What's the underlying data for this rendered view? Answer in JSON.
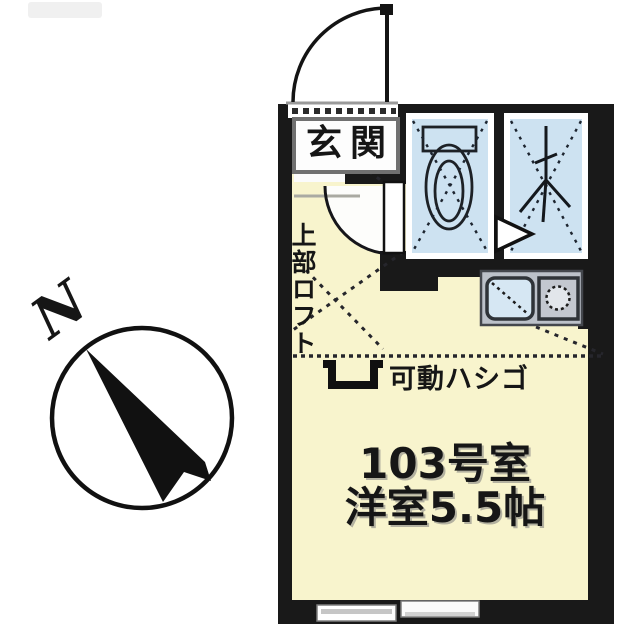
{
  "compass": {
    "north_label": "N"
  },
  "plan": {
    "entrance_label": "玄関",
    "loft_label": "上部ロフト",
    "ladder_label": "可動ハシゴ",
    "room_number": "103号室",
    "room_size": "洋室5.5帖"
  },
  "icons": [
    "north-compass-icon",
    "entrance-door-swing-icon",
    "interior-door-swing-icon",
    "toilet-icon",
    "shower-icon",
    "door-direction-triangle-icon",
    "kitchen-sink-icon",
    "stove-burner-icon",
    "loft-dashed-boundary-icon",
    "ladder-icon",
    "sliding-window-icon"
  ],
  "colors": {
    "wall": "#191919",
    "room_floor": "#f8f4cd",
    "wet_area": "#cde2f1",
    "sink": "#d6e7f3",
    "kitchen_counter": "#bcc1c9",
    "entrance_floor": "#fbfbfb",
    "label_box_border": "#707070"
  }
}
